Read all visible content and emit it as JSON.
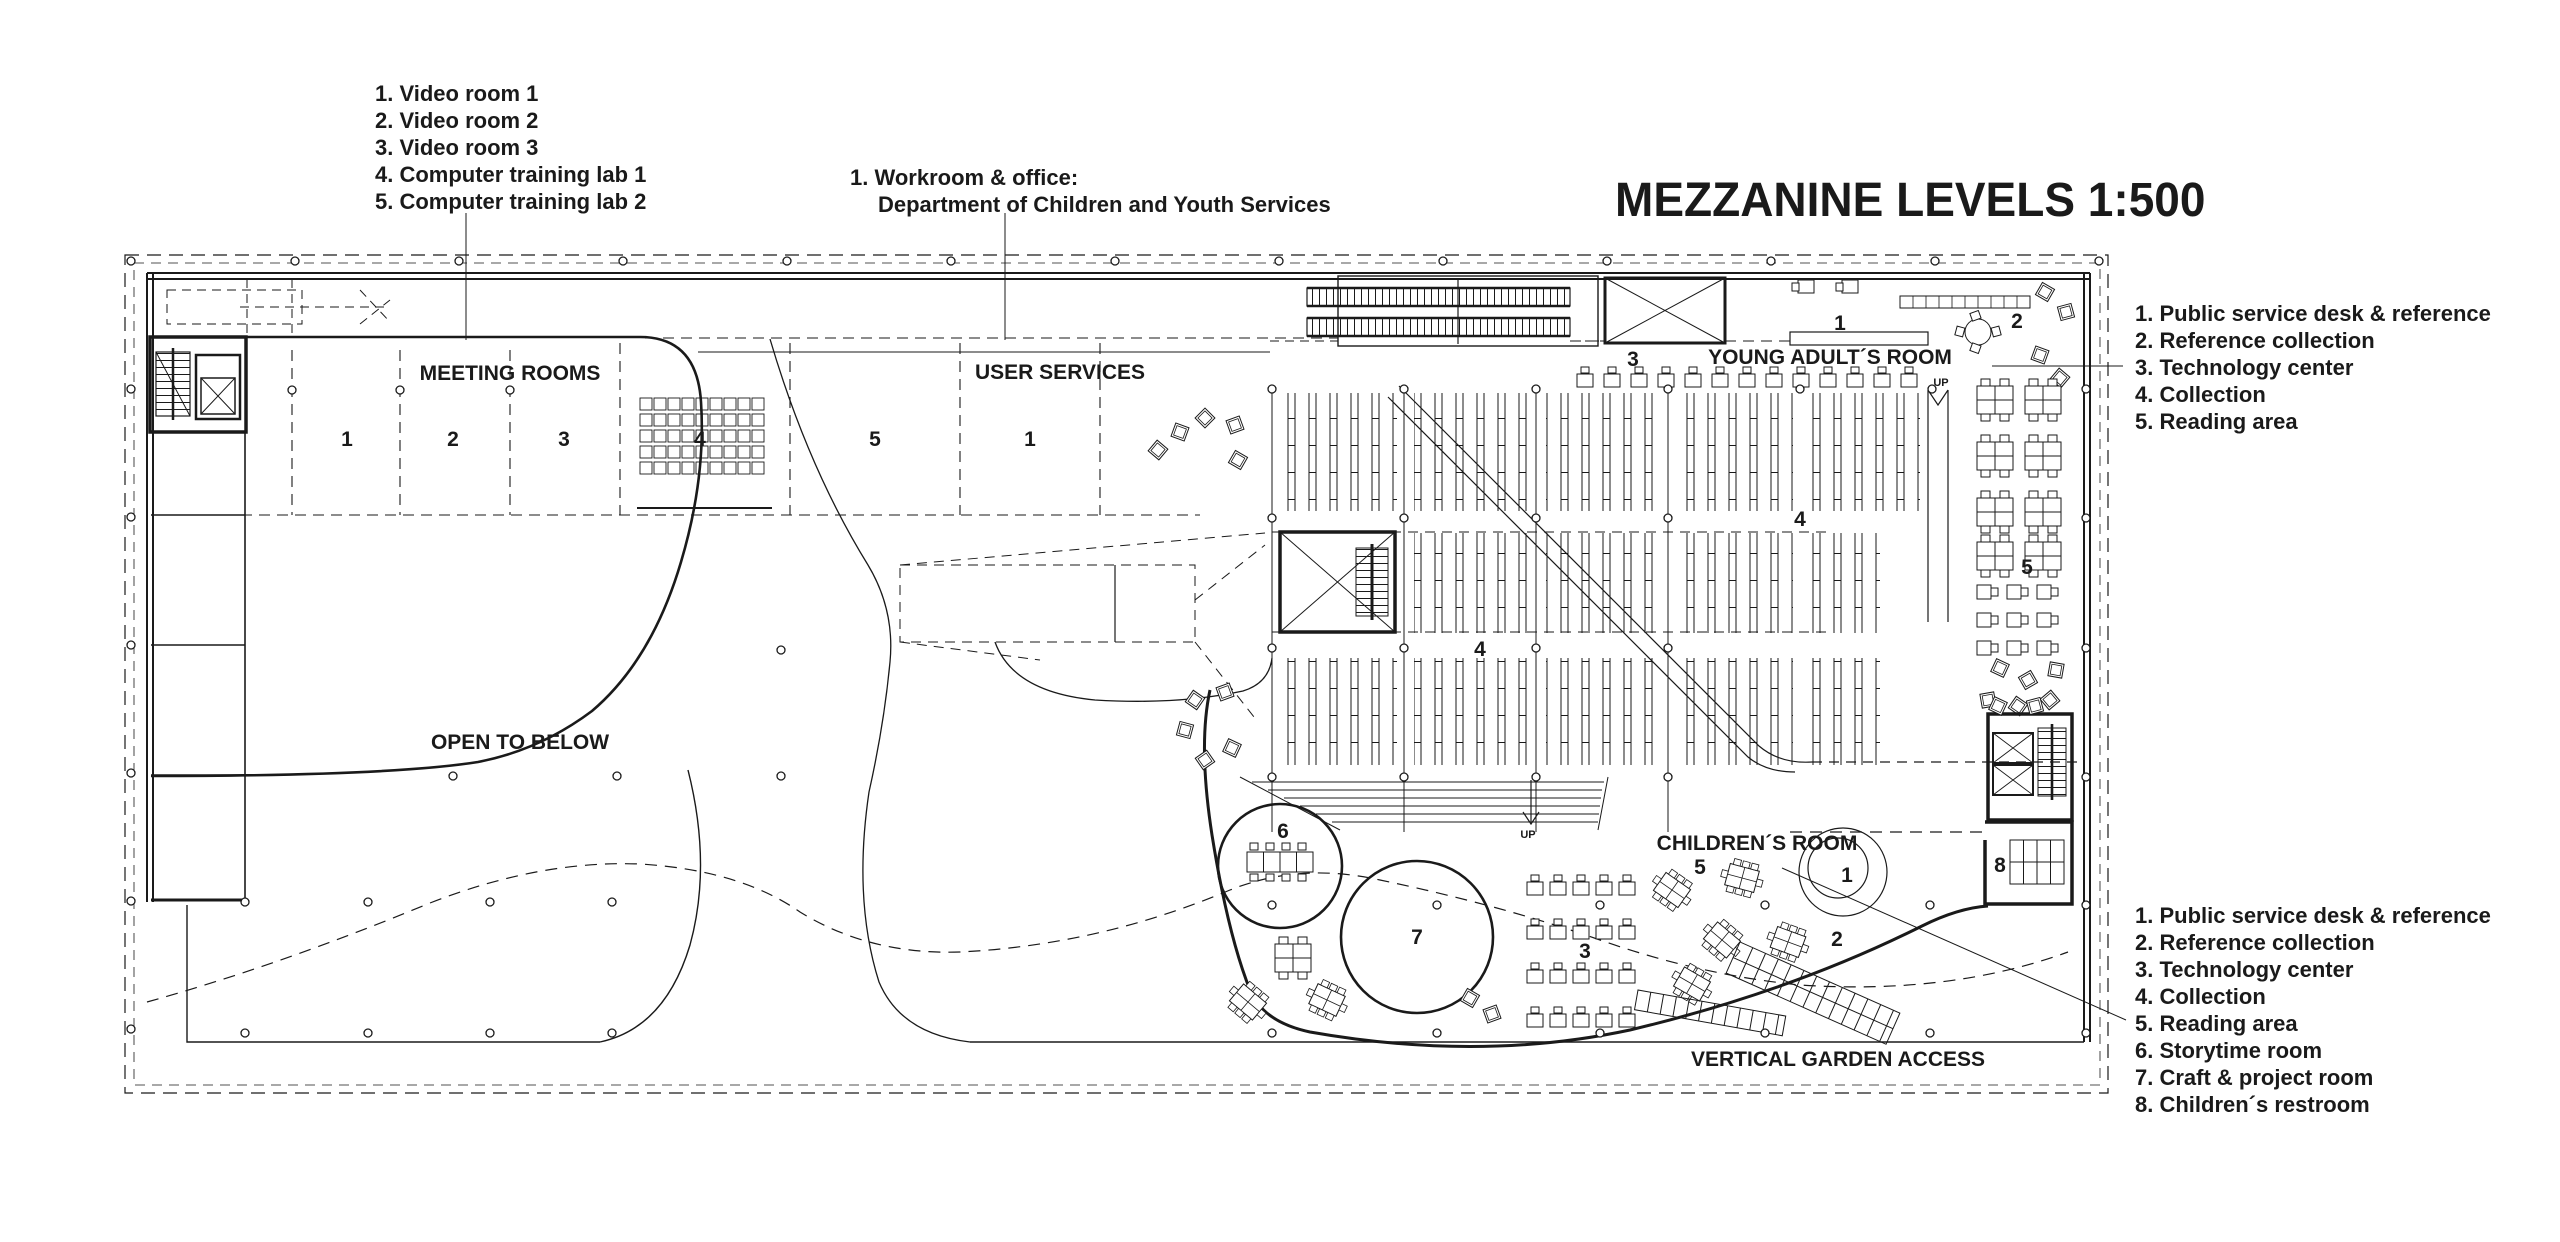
{
  "colors": {
    "ink": "#1a1a1a",
    "paper": "#ffffff"
  },
  "title": "MEZZANINE LEVELS 1:500",
  "legend_top_left": {
    "items": [
      "1. Video room 1",
      "2. Video room 2",
      "3. Video room 3",
      "4. Computer training lab 1",
      "5. Computer training lab 2"
    ]
  },
  "legend_workroom": {
    "line1": "1. Workroom & office:",
    "line2": "Department of Children and Youth Services"
  },
  "legend_top_right": {
    "items": [
      "1. Public service desk & reference",
      "2. Reference collection",
      "3. Technology center",
      "4. Collection",
      "5. Reading area"
    ]
  },
  "legend_bottom_right": {
    "items": [
      "1. Public service desk & reference",
      "2. Reference collection",
      "3. Technology center",
      "4. Collection",
      "5. Reading area",
      "6. Storytime room",
      "7. Craft & project room",
      "8. Children´s restroom"
    ]
  },
  "plan_labels": {
    "meeting_rooms": "MEETING ROOMS",
    "user_services": "USER SERVICES",
    "open_to_below": "OPEN TO BELOW",
    "young_adults_room": "YOUNG ADULT´S ROOM",
    "childrens_room": "CHILDREN´S ROOM",
    "vertical_garden_access": "VERTICAL GARDEN ACCESS"
  },
  "room_numbers": {
    "meeting_1": "1",
    "meeting_2": "2",
    "meeting_3": "3",
    "lab_4": "4",
    "lab_5": "5",
    "user_services_1": "1",
    "ya_tech_3": "3",
    "ya_desk_1": "1",
    "ya_ref_2": "2",
    "ya_reading_5": "5",
    "collection_4a": "4",
    "collection_4b": "4",
    "ch_reading_5": "5",
    "ch_desk_1": "1",
    "ch_ref_2": "2",
    "ch_tech_3": "3",
    "ch_storytime_6": "6",
    "ch_craft_7": "7",
    "ch_restroom_8": "8"
  },
  "up_label": "UP"
}
